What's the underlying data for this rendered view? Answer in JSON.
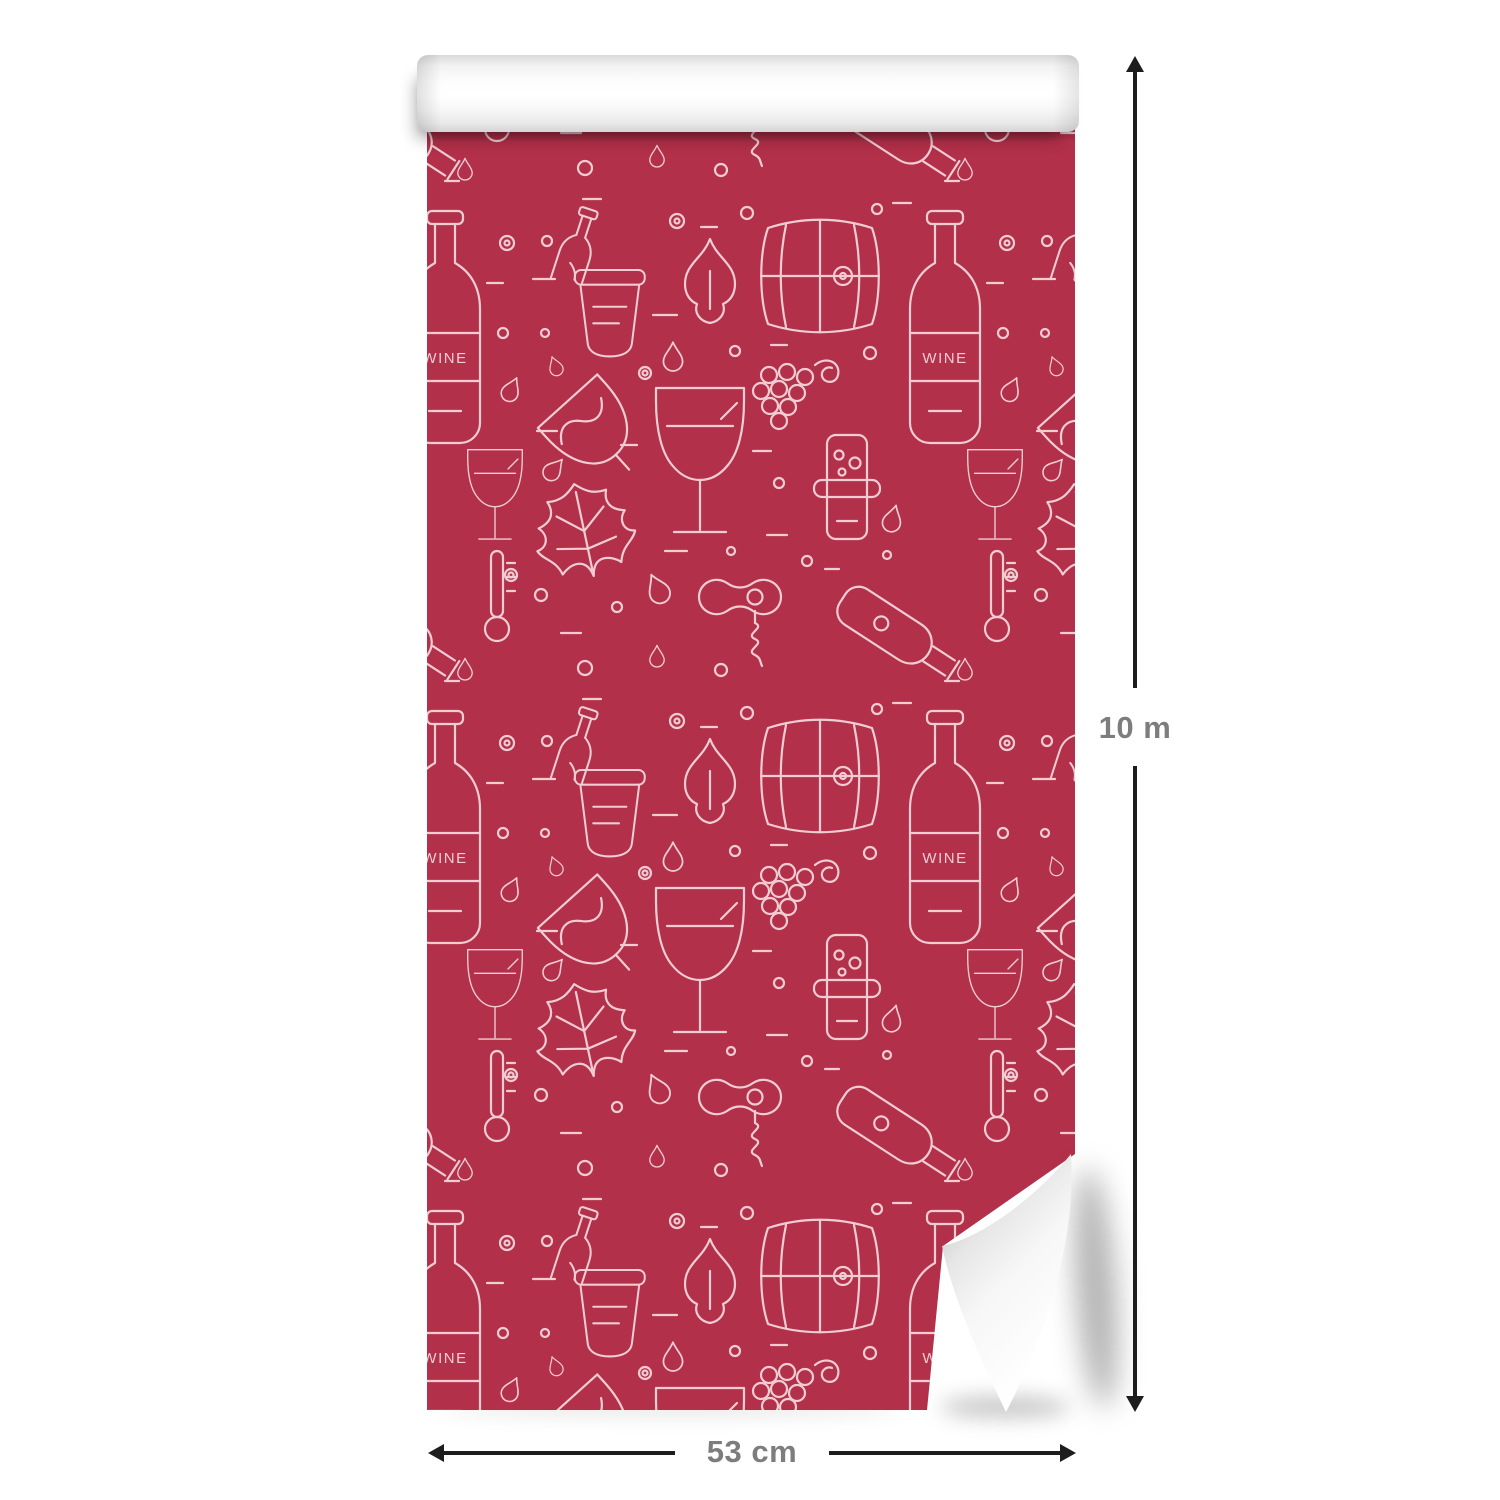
{
  "dimensions": {
    "height_label": "10 m",
    "width_label": "53 cm"
  },
  "wallpaper": {
    "wine_label": "WINE",
    "pattern_icons": [
      "wine-bottle-with-label",
      "wine-glass",
      "tilted-wine-glass",
      "wine-barrel",
      "ice-bucket-with-bottle",
      "cork-stopper-with-bubbles",
      "corkscrew",
      "pouring-bottle",
      "grape-bunch-with-tendril",
      "grape-leaf",
      "flame-leaf",
      "thermometer",
      "water-drop",
      "bubbles",
      "dashes"
    ],
    "colors": {
      "background_red": "#b23049",
      "pattern_line": "#f0ccd3",
      "roll_white": "#ffffff",
      "arrow_black": "#1d1d1d",
      "dimension_text_gray": "#7d7d7d"
    }
  }
}
